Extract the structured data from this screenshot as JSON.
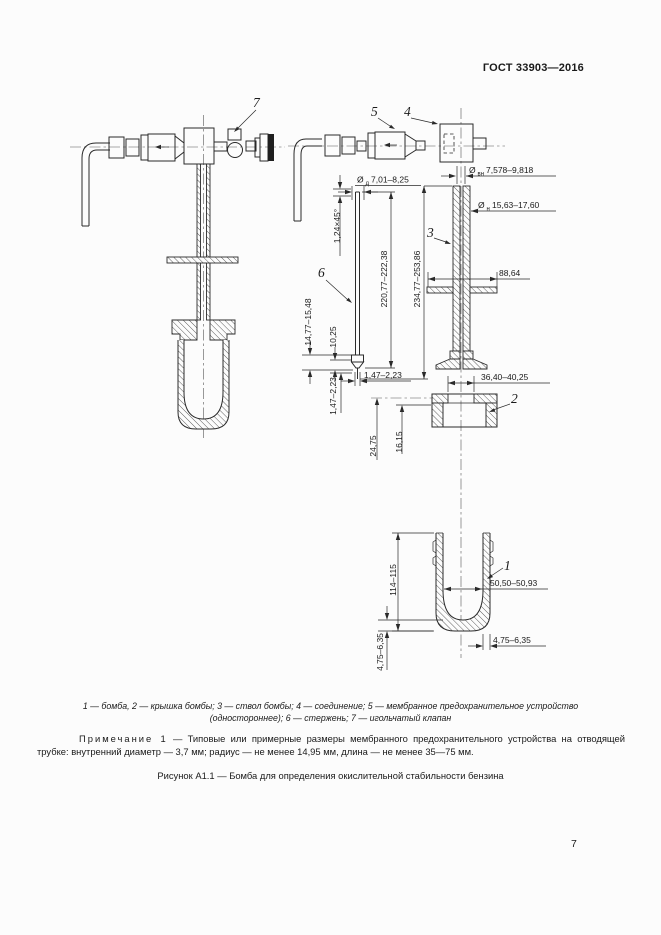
{
  "page": {
    "header": "ГОСТ 33903—2016",
    "page_number": "7"
  },
  "legend": {
    "line1": "1 — бомба, 2 — крышка бомбы; 3 — ствол бомбы; 4 — соединение; 5 — мембранное предохранительное устройство",
    "line2": "(одностороннее); 6 — стержень; 7 — игольчатый клапан"
  },
  "note": {
    "label": "Примечание 1",
    "body": "— Типовые или примерные размеры мембранного предохранительного устройства на отводящей трубке: внутренний диаметр — 3,7 мм; радиус — не менее 14,95 мм, длина — не менее 35—75 мм."
  },
  "caption": "Рисунок А1.1 — Бомба для определения окислительной стабильности бензина",
  "parts": {
    "p1": "1",
    "p2": "2",
    "p3": "3",
    "p4": "4",
    "p5": "5",
    "p6": "6",
    "p7": "7"
  },
  "dims": {
    "dia_vn_prefix": "Ø",
    "dia_vn_sub": "вн",
    "dia_vn_val": "7,578–9,818",
    "dia_n_prefix": "Ø",
    "dia_n_sub": "н",
    "dia_n_val": "15,63–17,60",
    "dia_d_prefix": "Ø",
    "dia_d_sub": "д",
    "dia_d_val": "7,01–8,25",
    "chamfer": "1,24×45°",
    "stem_length": "220,77–222,38",
    "barrel_length": "234,77–253,86",
    "flange_width": "88,64",
    "tip_length": "14,77–15,48",
    "tip_pin_length": "10,25",
    "tip_diameter": "1,47–2,23",
    "tip_height": "1,47–2,23",
    "cap_bore": "36,40–40,25",
    "cap_height": "24,75",
    "cap_depth": "16,15",
    "body_height": "114–115",
    "body_bore": "50,50–50,93",
    "wall_thickness": "4,75–6,35",
    "bottom_thickness": "4,75–6,35"
  }
}
